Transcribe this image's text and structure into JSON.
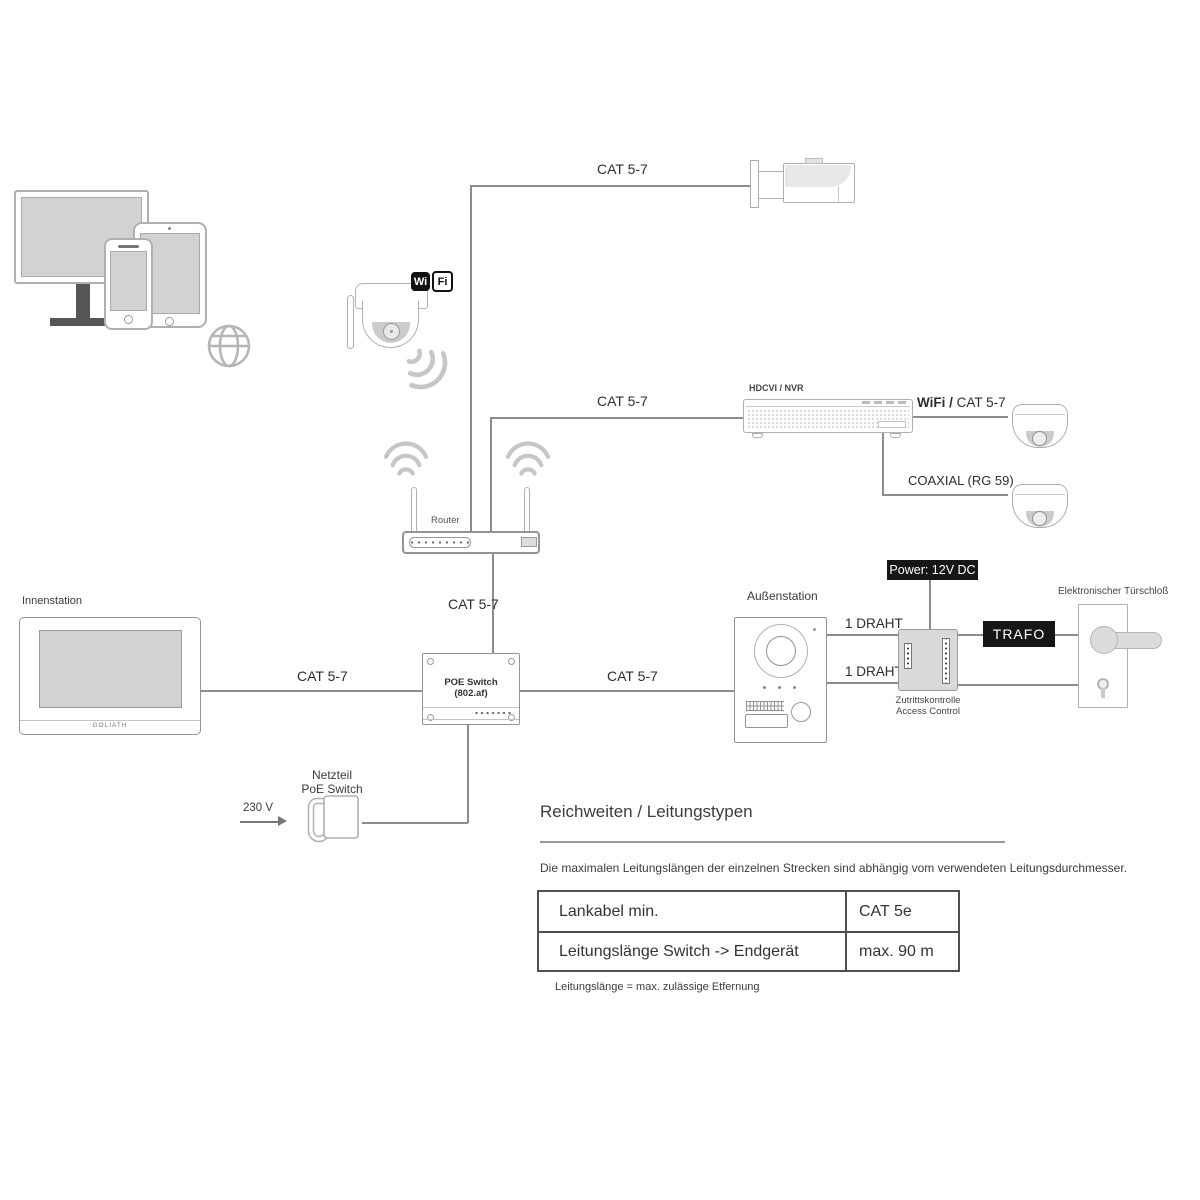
{
  "diagram": {
    "labels": {
      "cat57": "CAT 5-7",
      "router": "Router",
      "hdcvi_nvr": "HDCVI / NVR",
      "wifi_slash": "WiFi /",
      "coaxial": "COAXIAL (RG 59)",
      "power_12v": "Power: 12V DC",
      "one_draht": "1 DRAHT",
      "trafo": "TRAFO",
      "door_lock": "Elektronischer Türschloß",
      "access_line1": "Zutrittskontrolle",
      "access_line2": "Access Control",
      "outdoor_station": "Außenstation",
      "indoor_station": "Innenstation",
      "indoor_brand": "GOLIATH",
      "poe_line1": "POE Switch",
      "poe_line2": "(802.af)",
      "psu_line1": "Netzteil",
      "psu_line2": "PoE Switch",
      "voltage": "230 V",
      "wifi_badge_wi": "Wi",
      "wifi_badge_fi": "Fi"
    },
    "section": {
      "title": "Reichweiten / Leitungstypen",
      "description": "Die maximalen Leitungslängen der einzelnen Strecken sind abhängig vom verwendeten Leitungsdurchmesser.",
      "footnote": "Leitungslänge = max. zulässige Etfernung",
      "table": {
        "rows": [
          {
            "label": "Lankabel min.",
            "value": "CAT 5e"
          },
          {
            "label": "Leitungslänge Switch -> Endgerät",
            "value": "max. 90 m"
          }
        ]
      }
    },
    "colors": {
      "line": "#8c8c8c",
      "outline": "#b0b0b0",
      "dark_box": "#161616",
      "screen_fill": "#d2d2d2",
      "panel_fill": "#d9d9d9"
    }
  }
}
